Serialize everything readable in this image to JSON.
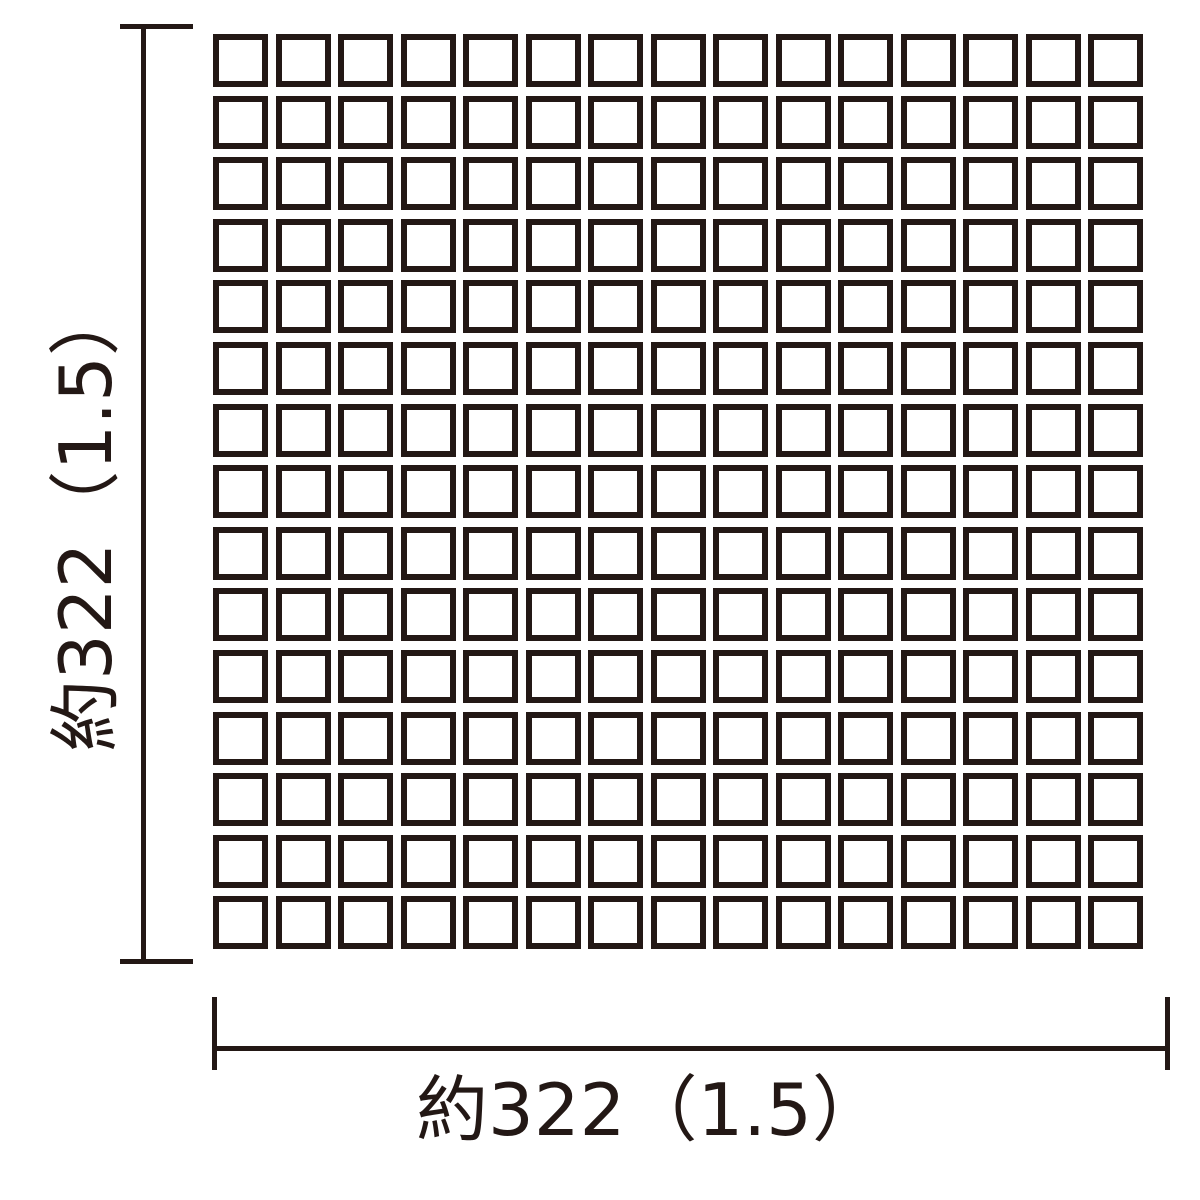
{
  "diagram": {
    "grid": {
      "rows": 15,
      "cols": 15
    },
    "dimensions": {
      "left": {
        "label": "約322（1.5）"
      },
      "bottom": {
        "label": "約322（1.5）"
      }
    },
    "colors": {
      "ink": "#231815",
      "background": "#ffffff"
    }
  }
}
